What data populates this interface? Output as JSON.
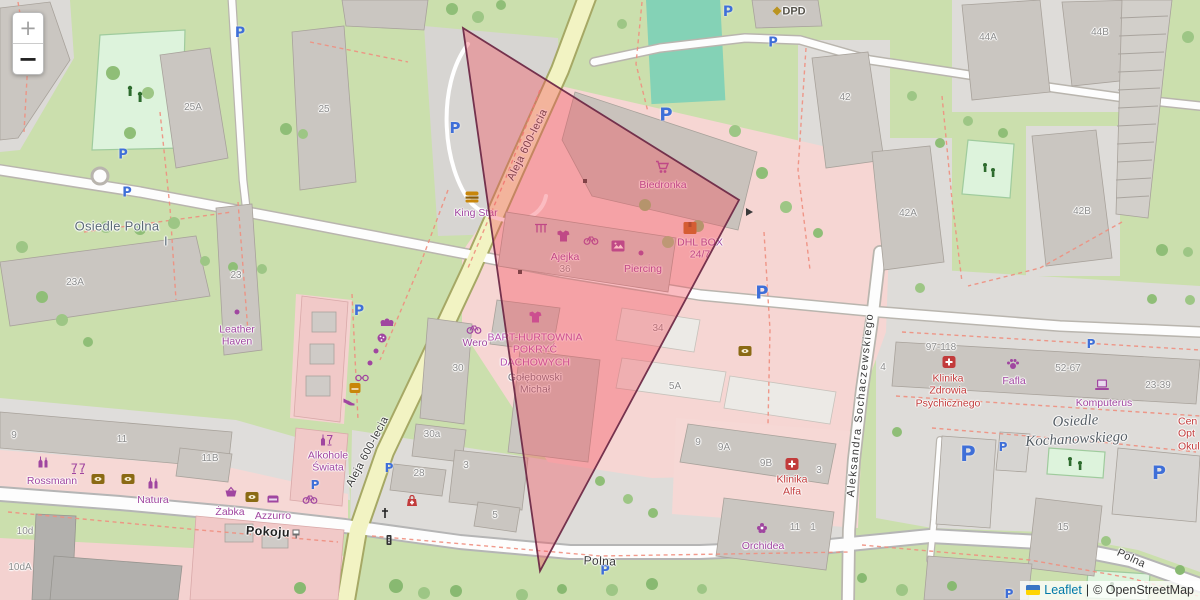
{
  "controls": {
    "zoom_in": "+",
    "zoom_out": "−"
  },
  "attribution": {
    "leaflet": "Leaflet",
    "separator": "|",
    "copyright": "© OpenStreetMap"
  },
  "parking_label": "P",
  "streets": [
    "Aleja 600-lecia",
    "Aleja 600-lecia",
    "Aleksandra Sochaczewskiego",
    "Polna",
    "Polna",
    "Pokoju"
  ],
  "places": [
    "Osiedle Polna",
    "I",
    "Osiedle\nKochanowskiego"
  ],
  "pois": [
    {
      "name": "King Star",
      "icon": "burger-icon"
    },
    {
      "name": "Biedronka",
      "icon": "shopping-cart-icon"
    },
    {
      "name": "DHL BOX\n24/7",
      "icon": "parcel-icon"
    },
    {
      "name": "Ajejka",
      "icon": "tshirt-icon"
    },
    {
      "name": "Piercing",
      "icon": "dot-icon"
    },
    {
      "name": "Wero",
      "icon": "bicycle-icon"
    },
    {
      "name": "BART-HURTOWNIA\nPOKRYĆ\nDACHOWYCH",
      "icon": "tshirt-icon"
    },
    {
      "name": "Gołębowski\nMichał",
      "icon": ""
    },
    {
      "name": "Leather\nHaven",
      "icon": "dot-icon"
    },
    {
      "name": "Rossmann",
      "icon": "bottles-icon"
    },
    {
      "name": "Natura",
      "icon": "bottles-icon"
    },
    {
      "name": "Żabka",
      "icon": "basket-icon"
    },
    {
      "name": "Azzurro",
      "icon": "couch-icon"
    },
    {
      "name": "Alkohole\nŚwiata",
      "icon": "bottle-glass-icon"
    },
    {
      "name": "Klinika\nZdrowia\nPsychicznego",
      "icon": "medical-icon"
    },
    {
      "name": "Fafla",
      "icon": "paw-icon"
    },
    {
      "name": "Komputerus",
      "icon": "laptop-icon"
    },
    {
      "name": "Klinika\nAlfa",
      "icon": "medical-icon"
    },
    {
      "name": "Orchidea",
      "icon": "flower-icon"
    },
    {
      "name": "DPD",
      "icon": "dpd-icon"
    },
    {
      "name": "Cen\nOpt\nOkul",
      "icon": ""
    }
  ],
  "housenumbers": [
    "25A",
    "25",
    "23A",
    "23",
    "44A",
    "44B",
    "42",
    "42A",
    "42B",
    "9",
    "11",
    "11B",
    "30",
    "30a",
    "28",
    "3",
    "5",
    "34",
    "5A",
    "36",
    "97-118",
    "52-67",
    "23-39",
    "4",
    "9",
    "9A",
    "9B",
    "3",
    "11",
    "1",
    "15",
    "10d",
    "10dA"
  ]
}
